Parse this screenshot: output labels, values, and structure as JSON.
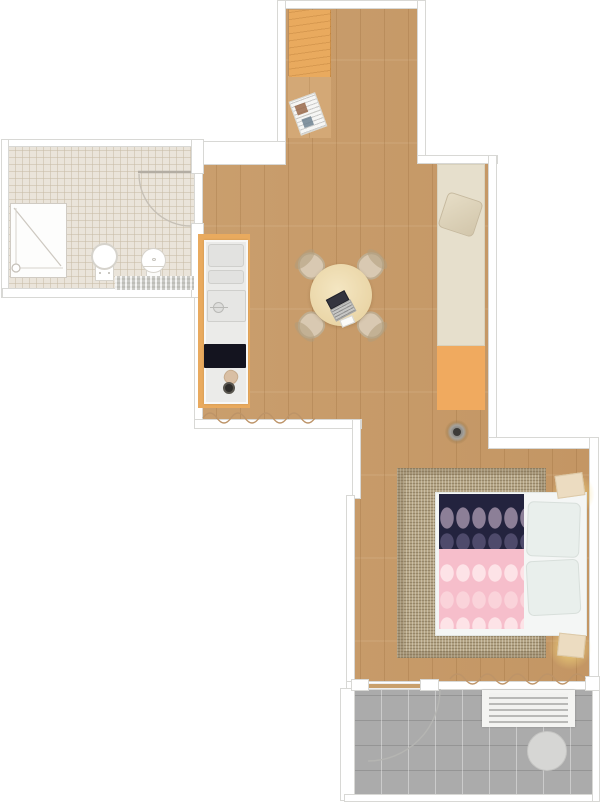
{
  "app": {
    "name": "apartment-floor-plan-viewer",
    "visible_text": []
  },
  "palette": {
    "wood": "#c79a68",
    "wood_light": "#d3a876",
    "wardrobe_orange": "#e9aa5e",
    "bath_tile": "#eae4da",
    "wall_line": "#d8d8d5",
    "counter_grey": "#ebebe9",
    "stove_black": "#14141f",
    "table_cream": "#eedcb2",
    "chair_beige": "#d9c9b2",
    "daybed_cushion": "#e6dfcc",
    "daybed_base": "#f0aa5f",
    "rug_tan": "#b3a384",
    "blanket_navy": "#23233e",
    "blanket_pink": "#f6becb",
    "bed_sheet": "#f4f6f5",
    "nightstand_beige": "#ecdcc1",
    "balcony_grey": "#ababab",
    "balcony_table_grey": "#d6d6d4",
    "bench_white": "#f4f4f2",
    "bath_mat_grey": "#dcdcd8"
  },
  "rooms": [
    {
      "id": "entry-hall",
      "floor": "wood",
      "furniture": [
        "wardrobe",
        "newspaper"
      ]
    },
    {
      "id": "bathroom",
      "floor": "tile",
      "furniture": [
        "shower",
        "toilet",
        "sink",
        "bath-mat",
        "door-swing"
      ]
    },
    {
      "id": "kitchen-living",
      "floor": "wood",
      "furniture": [
        "kitchen-counter",
        "fridge-top",
        "drawer-top",
        "kitchen-sink",
        "stove",
        "cutting-board",
        "pot",
        "dining-table",
        "chairs-x4",
        "laptop",
        "daybed",
        "throw-pillow",
        "floor-outlet",
        "window-curtain"
      ]
    },
    {
      "id": "bedroom",
      "floor": "wood",
      "furniture": [
        "area-rug",
        "double-bed",
        "navy-blanket",
        "pink-blanket",
        "pillows-x2",
        "nightstand-x2",
        "window-curtain"
      ]
    },
    {
      "id": "balcony",
      "floor": "pavers",
      "furniture": [
        "slatted-bench",
        "round-table",
        "door-swing"
      ]
    }
  ]
}
